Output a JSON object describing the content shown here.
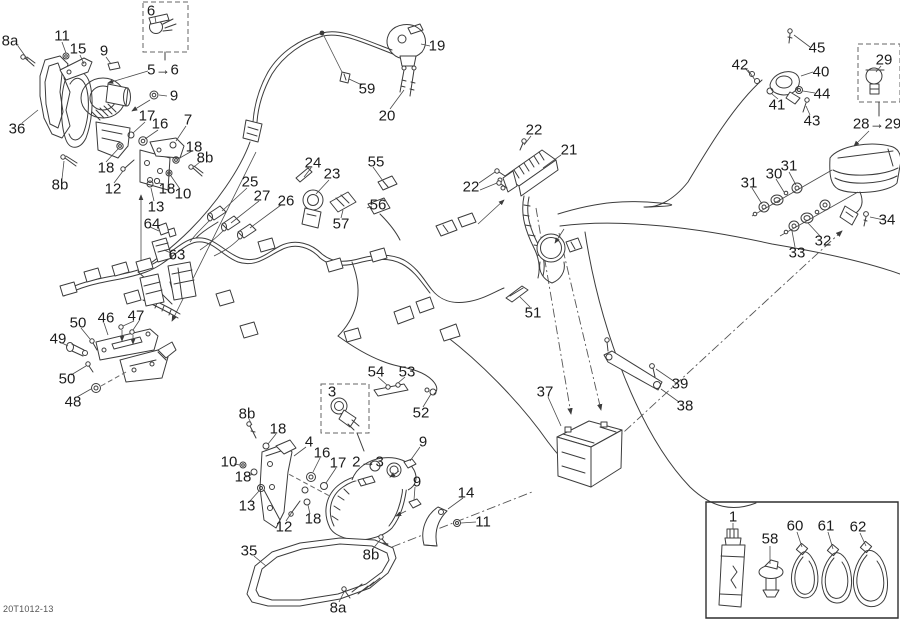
{
  "diagram": {
    "code": "20T1012-13"
  },
  "callouts": [
    {
      "text": "8a",
      "x": 10,
      "y": 41
    },
    {
      "text": "11",
      "x": 62,
      "y": 36
    },
    {
      "text": "15",
      "x": 78,
      "y": 49
    },
    {
      "text": "9",
      "x": 104,
      "y": 51
    },
    {
      "text": "6",
      "x": 151,
      "y": 11
    },
    {
      "text": "5→6",
      "x": 163,
      "y": 70
    },
    {
      "text": "9",
      "x": 174,
      "y": 96
    },
    {
      "text": "36",
      "x": 17,
      "y": 129
    },
    {
      "text": "17",
      "x": 147,
      "y": 116
    },
    {
      "text": "16",
      "x": 160,
      "y": 124
    },
    {
      "text": "7",
      "x": 188,
      "y": 120
    },
    {
      "text": "18",
      "x": 194,
      "y": 147
    },
    {
      "text": "8b",
      "x": 205,
      "y": 158
    },
    {
      "text": "18",
      "x": 106,
      "y": 168
    },
    {
      "text": "12",
      "x": 113,
      "y": 189
    },
    {
      "text": "13",
      "x": 156,
      "y": 207
    },
    {
      "text": "18",
      "x": 167,
      "y": 189
    },
    {
      "text": "10",
      "x": 183,
      "y": 194
    },
    {
      "text": "8b",
      "x": 60,
      "y": 185
    },
    {
      "text": "64",
      "x": 152,
      "y": 224
    },
    {
      "text": "63",
      "x": 177,
      "y": 255
    },
    {
      "text": "19",
      "x": 437,
      "y": 46
    },
    {
      "text": "59",
      "x": 367,
      "y": 89
    },
    {
      "text": "20",
      "x": 387,
      "y": 116
    },
    {
      "text": "24",
      "x": 313,
      "y": 163
    },
    {
      "text": "23",
      "x": 332,
      "y": 174
    },
    {
      "text": "55",
      "x": 376,
      "y": 162
    },
    {
      "text": "25",
      "x": 250,
      "y": 182
    },
    {
      "text": "27",
      "x": 262,
      "y": 196
    },
    {
      "text": "26",
      "x": 286,
      "y": 201
    },
    {
      "text": "57",
      "x": 341,
      "y": 224
    },
    {
      "text": "56",
      "x": 378,
      "y": 205
    },
    {
      "text": "22",
      "x": 534,
      "y": 130
    },
    {
      "text": "21",
      "x": 569,
      "y": 150
    },
    {
      "text": "22",
      "x": 471,
      "y": 187
    },
    {
      "text": "45",
      "x": 817,
      "y": 48
    },
    {
      "text": "42",
      "x": 740,
      "y": 65
    },
    {
      "text": "40",
      "x": 821,
      "y": 72
    },
    {
      "text": "44",
      "x": 822,
      "y": 94
    },
    {
      "text": "41",
      "x": 777,
      "y": 105
    },
    {
      "text": "43",
      "x": 812,
      "y": 121
    },
    {
      "text": "29",
      "x": 884,
      "y": 60
    },
    {
      "text": "28→29",
      "x": 877,
      "y": 124
    },
    {
      "text": "31",
      "x": 789,
      "y": 166
    },
    {
      "text": "30",
      "x": 774,
      "y": 174
    },
    {
      "text": "31",
      "x": 749,
      "y": 183
    },
    {
      "text": "34",
      "x": 887,
      "y": 220
    },
    {
      "text": "32",
      "x": 823,
      "y": 241
    },
    {
      "text": "33",
      "x": 797,
      "y": 253
    },
    {
      "text": "51",
      "x": 533,
      "y": 313
    },
    {
      "text": "54",
      "x": 376,
      "y": 372
    },
    {
      "text": "53",
      "x": 407,
      "y": 372
    },
    {
      "text": "52",
      "x": 421,
      "y": 413
    },
    {
      "text": "37",
      "x": 545,
      "y": 392
    },
    {
      "text": "39",
      "x": 680,
      "y": 384
    },
    {
      "text": "38",
      "x": 685,
      "y": 406
    },
    {
      "text": "46",
      "x": 106,
      "y": 318
    },
    {
      "text": "47",
      "x": 136,
      "y": 316
    },
    {
      "text": "50",
      "x": 78,
      "y": 323
    },
    {
      "text": "49",
      "x": 58,
      "y": 339
    },
    {
      "text": "50",
      "x": 67,
      "y": 379
    },
    {
      "text": "48",
      "x": 73,
      "y": 402
    },
    {
      "text": "8b",
      "x": 247,
      "y": 414
    },
    {
      "text": "18",
      "x": 278,
      "y": 429
    },
    {
      "text": "4",
      "x": 309,
      "y": 442
    },
    {
      "text": "16",
      "x": 322,
      "y": 453
    },
    {
      "text": "17",
      "x": 338,
      "y": 463
    },
    {
      "text": "10",
      "x": 229,
      "y": 462
    },
    {
      "text": "18",
      "x": 243,
      "y": 477
    },
    {
      "text": "13",
      "x": 247,
      "y": 506
    },
    {
      "text": "12",
      "x": 284,
      "y": 527
    },
    {
      "text": "18",
      "x": 313,
      "y": 519
    },
    {
      "text": "3",
      "x": 332,
      "y": 392
    },
    {
      "text": "2→3",
      "x": 368,
      "y": 462
    },
    {
      "text": "9",
      "x": 423,
      "y": 442
    },
    {
      "text": "9",
      "x": 417,
      "y": 482
    },
    {
      "text": "14",
      "x": 466,
      "y": 493
    },
    {
      "text": "11",
      "x": 483,
      "y": 522
    },
    {
      "text": "8b",
      "x": 371,
      "y": 555
    },
    {
      "text": "35",
      "x": 249,
      "y": 551
    },
    {
      "text": "8a",
      "x": 338,
      "y": 608
    },
    {
      "text": "1",
      "x": 733,
      "y": 517
    },
    {
      "text": "58",
      "x": 770,
      "y": 539
    },
    {
      "text": "60",
      "x": 795,
      "y": 526
    },
    {
      "text": "61",
      "x": 826,
      "y": 526
    },
    {
      "text": "62",
      "x": 858,
      "y": 527
    }
  ]
}
